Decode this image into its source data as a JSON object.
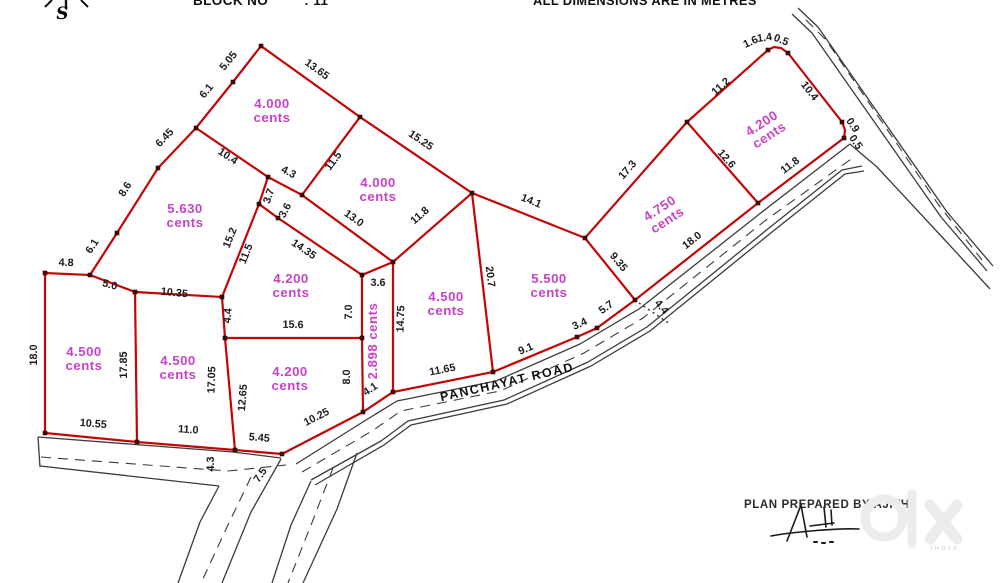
{
  "header": {
    "block_label": "BLOCK NO",
    "block_value": ": 11",
    "note": "ALL DIMENSIONS ARE IN METRES"
  },
  "compass": {
    "letter": "S"
  },
  "footer": {
    "prepared_by": "PLAN PREPARED BY AJITH"
  },
  "watermark": {
    "brand": "olx",
    "country": "INDIA"
  },
  "colors": {
    "plot_line": "#c30505",
    "area_text": "#c643c6",
    "dim_text": "#1c1c1c",
    "road_line": "#3b3b3b",
    "watermark": "#ececec"
  },
  "plan": {
    "road_label": {
      "text": "PANCHAYAT ROAD",
      "x": 508,
      "y": 386,
      "r": -13
    },
    "plots": [
      {
        "a": "4.000",
        "unit": "cents",
        "x": 272,
        "y": 108,
        "r": 0
      },
      {
        "a": "4.000",
        "unit": "cents",
        "x": 378,
        "y": 187,
        "r": 0
      },
      {
        "a": "5.630",
        "unit": "cents",
        "x": 185,
        "y": 213,
        "r": 0
      },
      {
        "a": "4.200",
        "unit": "cents",
        "x": 291,
        "y": 283,
        "r": 0
      },
      {
        "a": "4.500",
        "unit": "cents",
        "x": 84,
        "y": 356,
        "r": 0
      },
      {
        "a": "4.500",
        "unit": "cents",
        "x": 178,
        "y": 365,
        "r": 0
      },
      {
        "a": "4.200",
        "unit": "cents",
        "x": 290,
        "y": 376,
        "r": 0
      },
      {
        "a": "4.500",
        "unit": "cents",
        "x": 446,
        "y": 301,
        "r": 0
      },
      {
        "a": "5.500",
        "unit": "cents",
        "x": 549,
        "y": 283,
        "r": 0
      },
      {
        "a": "4.750",
        "unit": "cents",
        "x": 662,
        "y": 212,
        "r": -33
      },
      {
        "a": "4.200",
        "unit": "cents",
        "x": 764,
        "y": 127,
        "r": -33
      },
      {
        "a": "2.898",
        "unit": "cents",
        "x": 377,
        "y": 341,
        "r": -90,
        "vertical": true
      }
    ],
    "dims": [
      {
        "t": "5.05",
        "x": 231,
        "y": 63,
        "r": -51
      },
      {
        "t": "6.1",
        "x": 209,
        "y": 93,
        "r": -51
      },
      {
        "t": "13.65",
        "x": 315,
        "y": 72,
        "r": 36
      },
      {
        "t": "15.25",
        "x": 419,
        "y": 143,
        "r": 34
      },
      {
        "t": "10.4",
        "x": 226,
        "y": 159,
        "r": 34
      },
      {
        "t": "4.3",
        "x": 287,
        "y": 175,
        "r": 28
      },
      {
        "t": "11.5",
        "x": 336,
        "y": 163,
        "r": -53
      },
      {
        "t": "6.45",
        "x": 167,
        "y": 140,
        "r": -47
      },
      {
        "t": "8.6",
        "x": 128,
        "y": 191,
        "r": -58
      },
      {
        "t": "6.1",
        "x": 95,
        "y": 248,
        "r": -57
      },
      {
        "t": "4.8",
        "x": 66,
        "y": 266,
        "r": 2
      },
      {
        "t": "5.0",
        "x": 109,
        "y": 288,
        "r": 15
      },
      {
        "t": "10.35",
        "x": 174,
        "y": 296,
        "r": 6
      },
      {
        "t": "3.7",
        "x": 272,
        "y": 197,
        "r": -72
      },
      {
        "t": "3.6",
        "x": 288,
        "y": 212,
        "r": -62
      },
      {
        "t": "15.2",
        "x": 233,
        "y": 239,
        "r": -68
      },
      {
        "t": "11.5",
        "x": 249,
        "y": 255,
        "r": -68
      },
      {
        "t": "13.0",
        "x": 352,
        "y": 221,
        "r": 36
      },
      {
        "t": "14.35",
        "x": 302,
        "y": 252,
        "r": 34
      },
      {
        "t": "11.8",
        "x": 422,
        "y": 218,
        "r": -41
      },
      {
        "t": "14.1",
        "x": 530,
        "y": 204,
        "r": 22
      },
      {
        "t": "17.3",
        "x": 630,
        "y": 172,
        "r": -49
      },
      {
        "t": "11.2",
        "x": 723,
        "y": 89,
        "r": -42
      },
      {
        "t": "1.6",
        "x": 752,
        "y": 45,
        "r": -25
      },
      {
        "t": "1.4",
        "x": 765,
        "y": 41,
        "r": -8
      },
      {
        "t": "0.5",
        "x": 780,
        "y": 43,
        "r": 22
      },
      {
        "t": "10.4",
        "x": 807,
        "y": 93,
        "r": 52
      },
      {
        "t": "0.9",
        "x": 850,
        "y": 127,
        "r": 55
      },
      {
        "t": "0.5",
        "x": 853,
        "y": 144,
        "r": 55
      },
      {
        "t": "12.6",
        "x": 724,
        "y": 161,
        "r": 49
      },
      {
        "t": "11.8",
        "x": 792,
        "y": 168,
        "r": -37
      },
      {
        "t": "9.35",
        "x": 616,
        "y": 264,
        "r": 51
      },
      {
        "t": "18.0",
        "x": 694,
        "y": 243,
        "r": -38
      },
      {
        "t": "4.4",
        "x": 659,
        "y": 309,
        "r": 50
      },
      {
        "t": "5.7",
        "x": 608,
        "y": 310,
        "r": -36
      },
      {
        "t": "3.4",
        "x": 581,
        "y": 327,
        "r": -24
      },
      {
        "t": "9.1",
        "x": 527,
        "y": 352,
        "r": -23
      },
      {
        "t": "20.7",
        "x": 487,
        "y": 277,
        "r": 83
      },
      {
        "t": "11.65",
        "x": 443,
        "y": 373,
        "r": -11
      },
      {
        "t": "14.75",
        "x": 404,
        "y": 319,
        "r": -88
      },
      {
        "t": "3.6",
        "x": 378,
        "y": 286,
        "r": 0
      },
      {
        "t": "7.0",
        "x": 352,
        "y": 312,
        "r": -90
      },
      {
        "t": "8.0",
        "x": 350,
        "y": 377,
        "r": -90
      },
      {
        "t": "4.1",
        "x": 372,
        "y": 392,
        "r": -33
      },
      {
        "t": "15.6",
        "x": 293,
        "y": 328,
        "r": 1
      },
      {
        "t": "4.4",
        "x": 231,
        "y": 316,
        "r": -85
      },
      {
        "t": "17.05",
        "x": 215,
        "y": 380,
        "r": -88
      },
      {
        "t": "12.65",
        "x": 246,
        "y": 398,
        "r": -85
      },
      {
        "t": "17.85",
        "x": 127,
        "y": 365,
        "r": -90
      },
      {
        "t": "18.0",
        "x": 37,
        "y": 355,
        "r": -90
      },
      {
        "t": "10.55",
        "x": 93,
        "y": 427,
        "r": 5
      },
      {
        "t": "11.0",
        "x": 188,
        "y": 433,
        "r": 4
      },
      {
        "t": "5.45",
        "x": 259,
        "y": 441,
        "r": 5
      },
      {
        "t": "10.25",
        "x": 318,
        "y": 420,
        "r": -27
      },
      {
        "t": "4.3",
        "x": 214,
        "y": 464,
        "r": -90
      },
      {
        "t": "7.5",
        "x": 263,
        "y": 477,
        "r": -55
      }
    ],
    "red_lines": [
      [
        [
          196,
          128
        ],
        [
          233,
          82
        ],
        [
          261,
          46
        ]
      ],
      [
        [
          261,
          46
        ],
        [
          360,
          117
        ],
        [
          472,
          193
        ]
      ],
      [
        [
          360,
          117
        ],
        [
          302,
          195
        ],
        [
          268,
          177
        ],
        [
          196,
          128
        ]
      ],
      [
        [
          196,
          128
        ],
        [
          158,
          168
        ],
        [
          117,
          233
        ],
        [
          90,
          275
        ],
        [
          135,
          292
        ],
        [
          222,
          297
        ]
      ],
      [
        [
          268,
          177
        ],
        [
          259,
          204
        ],
        [
          222,
          297
        ]
      ],
      [
        [
          259,
          204
        ],
        [
          278,
          218
        ],
        [
          362,
          275
        ]
      ],
      [
        [
          302,
          195
        ],
        [
          393,
          262
        ],
        [
          472,
          193
        ]
      ],
      [
        [
          472,
          193
        ],
        [
          585,
          238
        ],
        [
          687,
          122
        ],
        [
          768,
          50
        ],
        [
          774,
          47
        ],
        [
          781,
          48
        ],
        [
          788,
          53
        ],
        [
          842,
          122
        ],
        [
          845,
          130
        ],
        [
          844,
          138
        ],
        [
          758,
          203
        ],
        [
          687,
          122
        ]
      ],
      [
        [
          758,
          203
        ],
        [
          635,
          300
        ],
        [
          585,
          238
        ]
      ],
      [
        [
          635,
          300
        ],
        [
          597,
          328
        ],
        [
          577,
          337
        ],
        [
          493,
          372
        ],
        [
          393,
          392
        ],
        [
          363,
          412
        ],
        [
          282,
          454
        ],
        [
          235,
          450
        ],
        [
          137,
          442
        ],
        [
          45,
          433
        ],
        [
          45,
          273
        ],
        [
          90,
          275
        ]
      ],
      [
        [
          135,
          292
        ],
        [
          137,
          442
        ]
      ],
      [
        [
          222,
          297
        ],
        [
          225,
          338
        ],
        [
          235,
          450
        ]
      ],
      [
        [
          225,
          338
        ],
        [
          362,
          338
        ]
      ],
      [
        [
          362,
          275
        ],
        [
          362,
          338
        ],
        [
          363,
          412
        ]
      ],
      [
        [
          362,
          275
        ],
        [
          393,
          262
        ],
        [
          393,
          392
        ]
      ],
      [
        [
          472,
          193
        ],
        [
          493,
          372
        ]
      ]
    ],
    "tie_lines": [
      [
        [
          639,
          303
        ],
        [
          670,
          324
        ]
      ]
    ],
    "vertices": [
      [
        261,
        46
      ],
      [
        233,
        82
      ],
      [
        196,
        128
      ],
      [
        158,
        168
      ],
      [
        117,
        233
      ],
      [
        90,
        275
      ],
      [
        45,
        273
      ],
      [
        45,
        433
      ],
      [
        137,
        442
      ],
      [
        135,
        292
      ],
      [
        222,
        297
      ],
      [
        225,
        338
      ],
      [
        235,
        450
      ],
      [
        282,
        454
      ],
      [
        363,
        412
      ],
      [
        393,
        392
      ],
      [
        493,
        372
      ],
      [
        577,
        337
      ],
      [
        597,
        328
      ],
      [
        635,
        300
      ],
      [
        585,
        238
      ],
      [
        472,
        193
      ],
      [
        360,
        117
      ],
      [
        302,
        195
      ],
      [
        268,
        177
      ],
      [
        259,
        204
      ],
      [
        278,
        218
      ],
      [
        362,
        275
      ],
      [
        362,
        338
      ],
      [
        393,
        262
      ],
      [
        687,
        122
      ],
      [
        758,
        203
      ],
      [
        768,
        50
      ],
      [
        788,
        53
      ],
      [
        842,
        122
      ],
      [
        844,
        138
      ]
    ],
    "road_solid": [
      [
        [
          38,
          437
        ],
        [
          233,
          452
        ],
        [
          281,
          458
        ]
      ],
      [
        [
          38,
          437
        ],
        [
          40,
          467
        ]
      ],
      [
        [
          40,
          466
        ],
        [
          219,
          486
        ]
      ],
      [
        [
          296,
          464
        ],
        [
          366,
          420
        ],
        [
          397,
          401
        ],
        [
          496,
          381
        ],
        [
          580,
          344
        ],
        [
          639,
          309
        ],
        [
          762,
          212
        ],
        [
          850,
          144
        ]
      ],
      [
        [
          850,
          144
        ],
        [
          864,
          156
        ],
        [
          877,
          167
        ],
        [
          943,
          238
        ],
        [
          990,
          289
        ]
      ],
      [
        [
          311,
          480
        ],
        [
          381,
          441
        ],
        [
          408,
          421
        ],
        [
          504,
          400
        ],
        [
          588,
          362
        ],
        [
          647,
          327
        ],
        [
          769,
          228
        ],
        [
          842,
          170
        ],
        [
          862,
          166
        ]
      ],
      [
        [
          315,
          485
        ],
        [
          384,
          445
        ],
        [
          411,
          425
        ],
        [
          507,
          404
        ],
        [
          591,
          366
        ],
        [
          650,
          331
        ],
        [
          772,
          232
        ],
        [
          845,
          174
        ],
        [
          864,
          171
        ]
      ],
      [
        [
          798,
          8
        ],
        [
          818,
          27
        ],
        [
          947,
          212
        ],
        [
          993,
          266
        ]
      ],
      [
        [
          792,
          14
        ],
        [
          812,
          33
        ],
        [
          941,
          217
        ],
        [
          987,
          271
        ]
      ],
      [
        [
          219,
          486
        ],
        [
          200,
          522
        ],
        [
          178,
          583
        ]
      ],
      [
        [
          281,
          459
        ],
        [
          251,
          512
        ],
        [
          222,
          583
        ]
      ],
      [
        [
          311,
          481
        ],
        [
          291,
          525
        ],
        [
          272,
          583
        ]
      ],
      [
        [
          357,
          453
        ],
        [
          337,
          509
        ],
        [
          303,
          583
        ]
      ]
    ],
    "road_dashed": [
      [
        [
          41,
          457
        ],
        [
          228,
          471
        ],
        [
          286,
          465
        ]
      ],
      [
        [
          302,
          472
        ],
        [
          372,
          431
        ],
        [
          401,
          411
        ],
        [
          500,
          391
        ],
        [
          584,
          353
        ],
        [
          643,
          318
        ],
        [
          766,
          220
        ],
        [
          854,
          157
        ]
      ],
      [
        [
          806,
          20
        ],
        [
          826,
          40
        ],
        [
          938,
          204
        ],
        [
          982,
          260
        ]
      ],
      [
        [
          251,
          477
        ],
        [
          227,
          527
        ],
        [
          201,
          583
        ]
      ],
      [
        [
          333,
          468
        ],
        [
          313,
          520
        ],
        [
          288,
          583
        ]
      ]
    ]
  }
}
